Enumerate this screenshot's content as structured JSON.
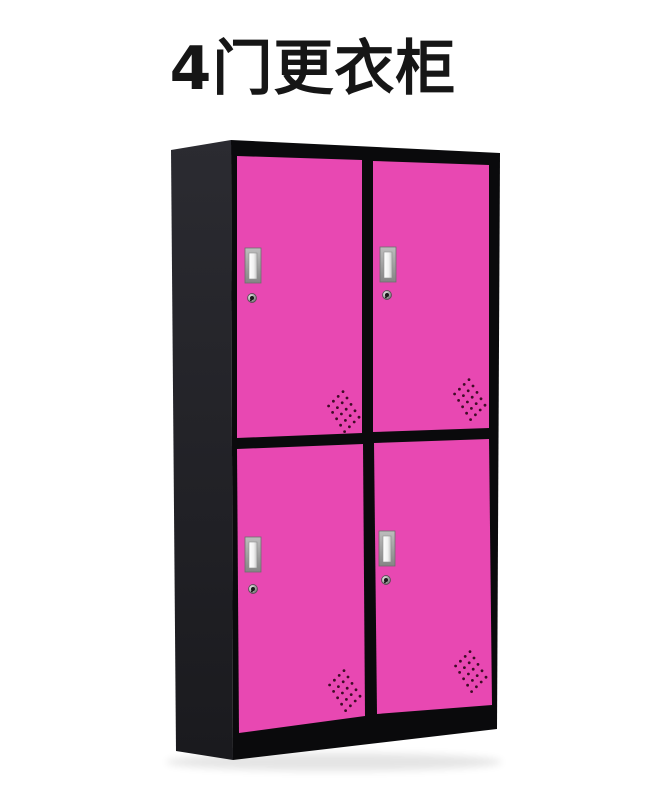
{
  "title": "4门更衣柜",
  "colors": {
    "door_pink": "#E848B2",
    "frame_black": "#0A0A0C",
    "side_panel_dark": "#26262B",
    "handle_silver": "#B5B5B5",
    "handle_inner": "#F2F2F2",
    "vent_dot": "#3F0A26",
    "title_text": "#161616",
    "background": "#FFFFFF"
  }
}
